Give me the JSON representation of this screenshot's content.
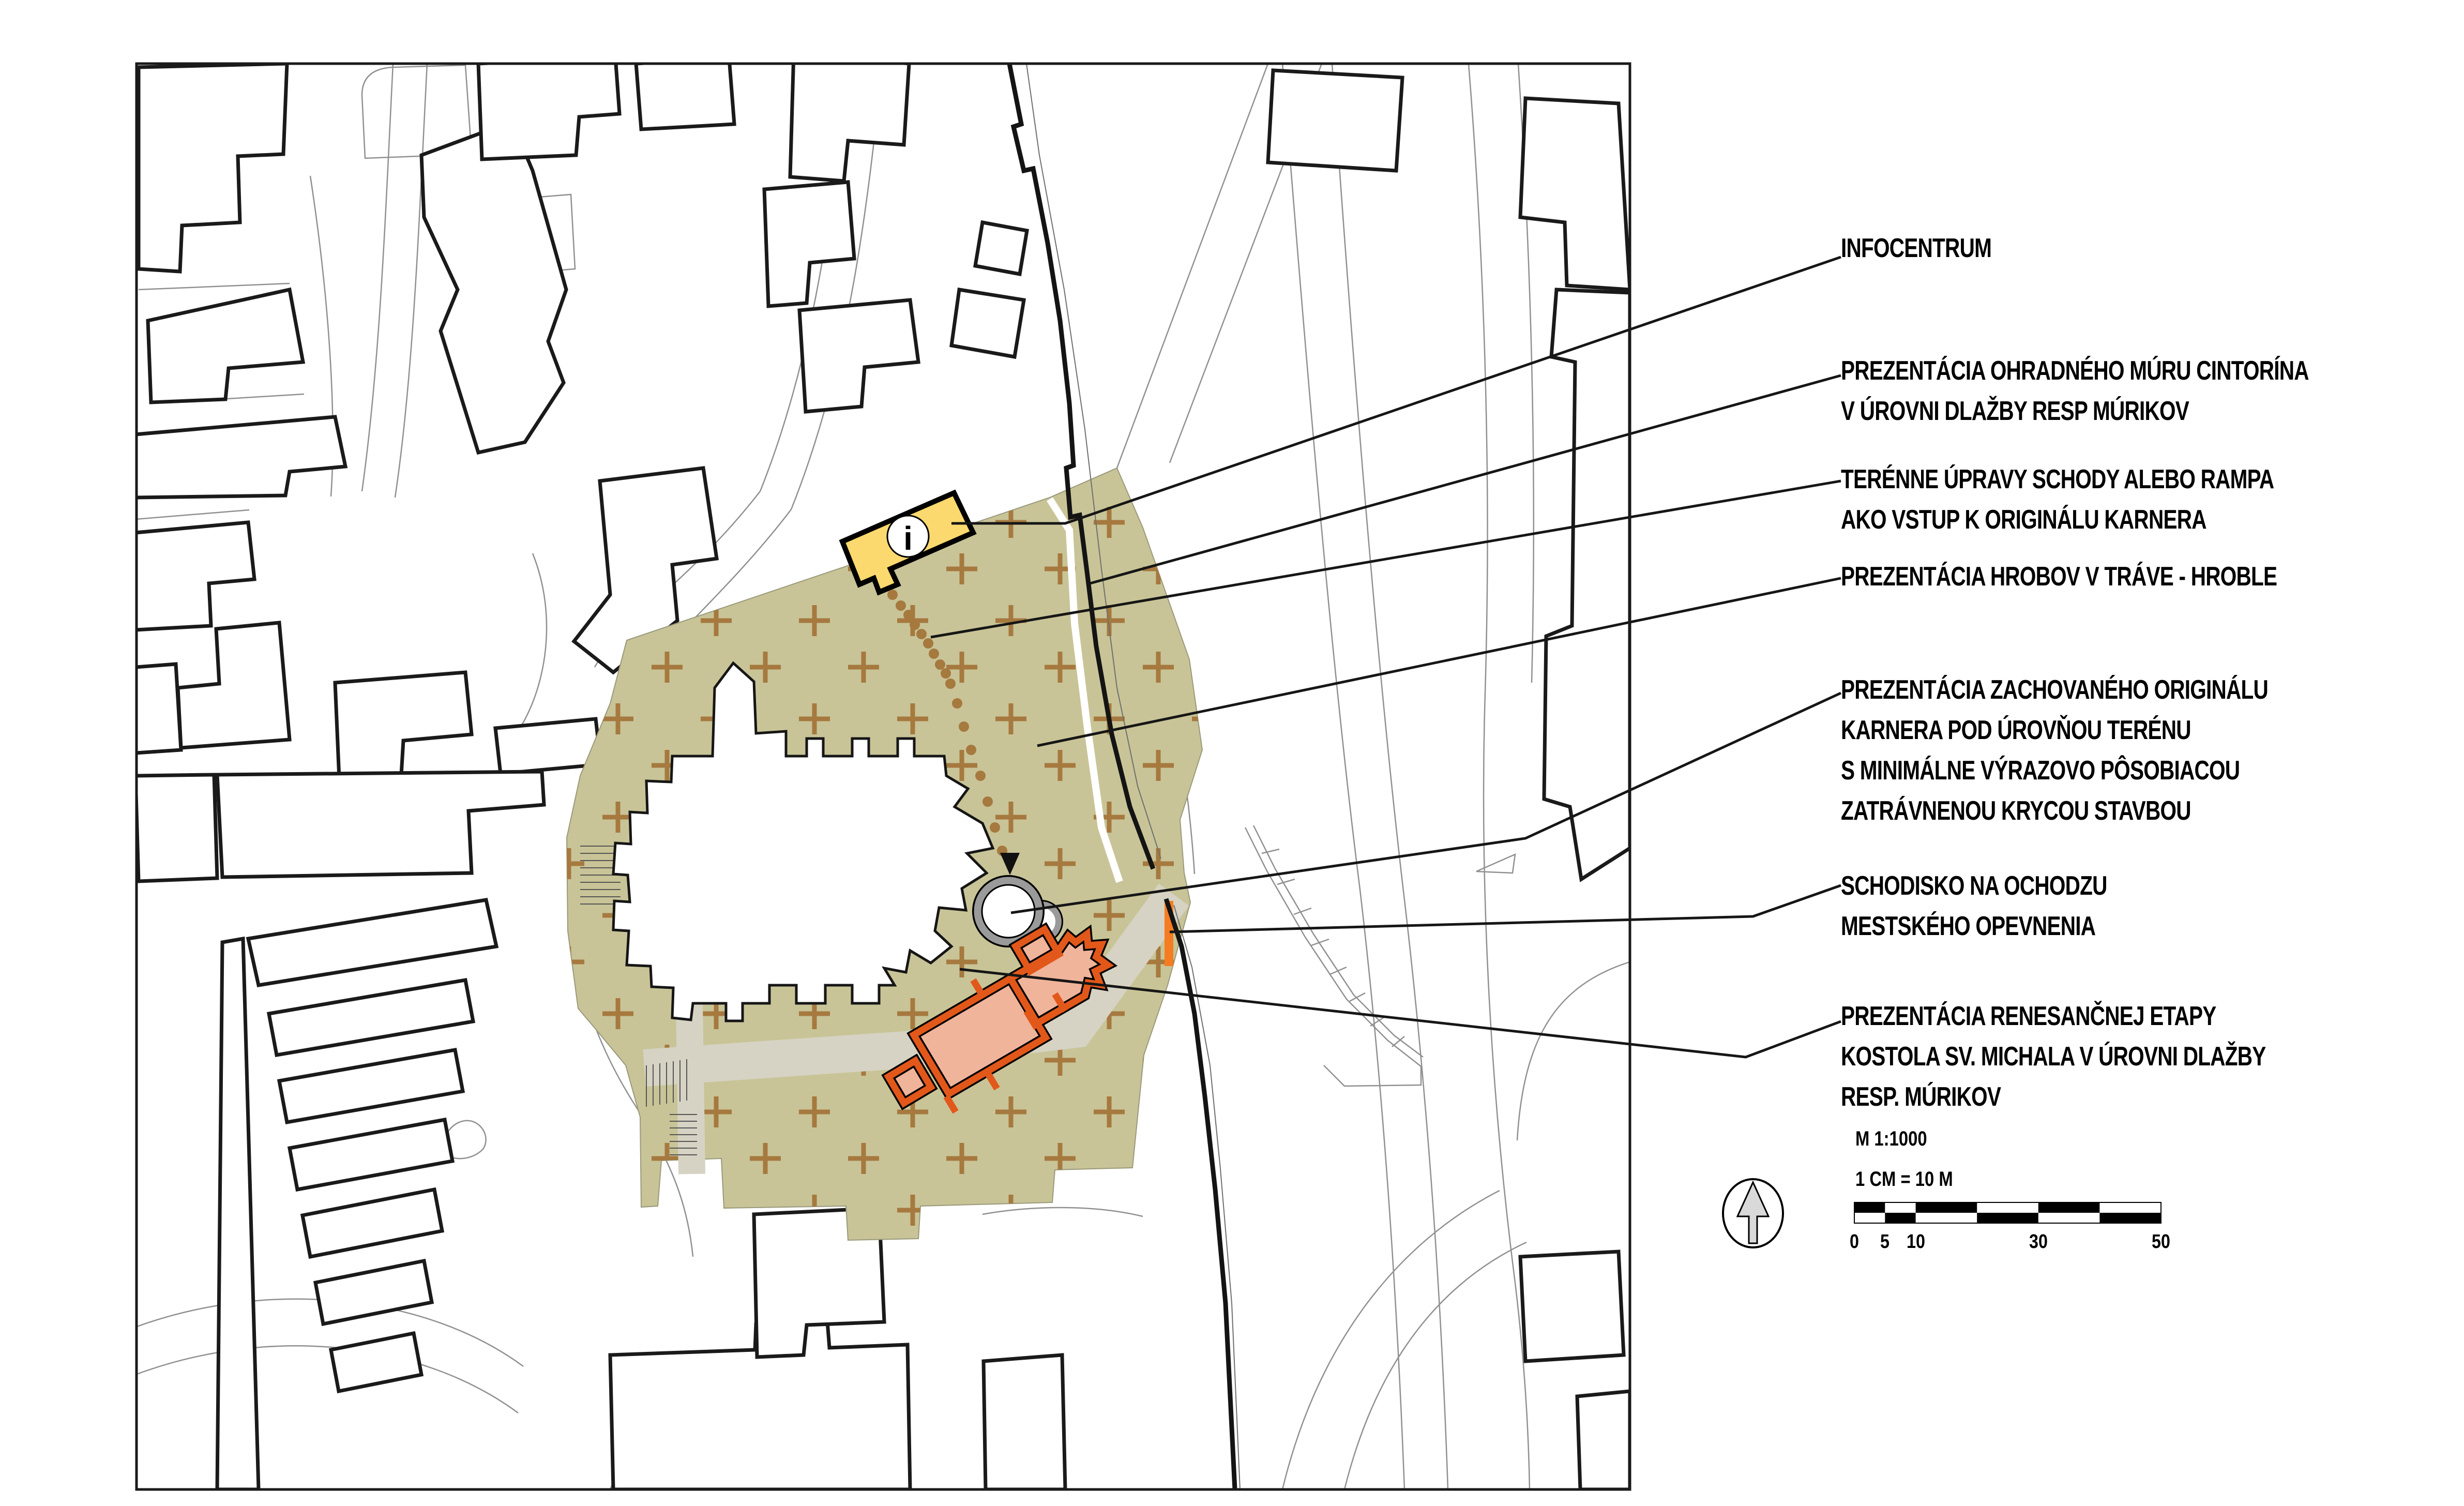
{
  "annotations": [
    {
      "id": "infocentrum",
      "lines": [
        "INFOCENTRUM"
      ]
    },
    {
      "id": "ohradny-mur",
      "lines": [
        "PREZENTÁCIA OHRADNÉHO MÚRU CINTORÍNA",
        "V ÚROVNI DLAŽBY RESP MÚRIKOV"
      ]
    },
    {
      "id": "terenne-upravy",
      "lines": [
        "TERÉNNE ÚPRAVY SCHODY ALEBO RAMPA",
        "AKO VSTUP K ORIGINÁLU KARNERA"
      ]
    },
    {
      "id": "hroble",
      "lines": [
        "PREZENTÁCIA HROBOV V TRÁVE - HROBLE"
      ]
    },
    {
      "id": "karner",
      "lines": [
        "PREZENTÁCIA ZACHOVANÉHO ORIGINÁLU",
        "KARNERA POD ÚROVŇOU TERÉNU",
        "S MINIMÁLNE VÝRAZOVO PÔSOBIACOU",
        "ZATRÁVNENOU KRYCOU STAVBOU"
      ]
    },
    {
      "id": "schodisko",
      "lines": [
        "SCHODISKO NA OCHODZU",
        "MESTSKÉHO OPEVNENIA"
      ]
    },
    {
      "id": "renesancna-etapa",
      "lines": [
        "PREZENTÁCIA RENESANČNEJ ETAPY",
        "KOSTOLA SV. MICHALA V ÚROVNI DLAŽBY",
        "RESP. MÚRIKOV"
      ]
    }
  ],
  "scale": {
    "ratio": "M 1:1000",
    "equivalence": "1 CM =  10 M",
    "tick_labels": [
      "0",
      "5",
      "10",
      "30",
      "50"
    ],
    "total_meters": 50
  },
  "infocentrum_icon": "i",
  "colors": {
    "grass": "#c8c497",
    "cross": "#a6793f",
    "path-gray": "#d6d3c4",
    "building-stroke": "#1a1a1a",
    "parcel-line": "#909090",
    "wall": "#141414",
    "frame": "#1a1a1a",
    "infocentrum-fill": "#fcd96e",
    "karner-ring": "#9a9a9a",
    "renaissance-outline": "#e2581a",
    "renaissance-fill": "#f0b49b",
    "stairs-orange": "#f57c20",
    "north-arrow-fill": "#d9d9d9"
  }
}
